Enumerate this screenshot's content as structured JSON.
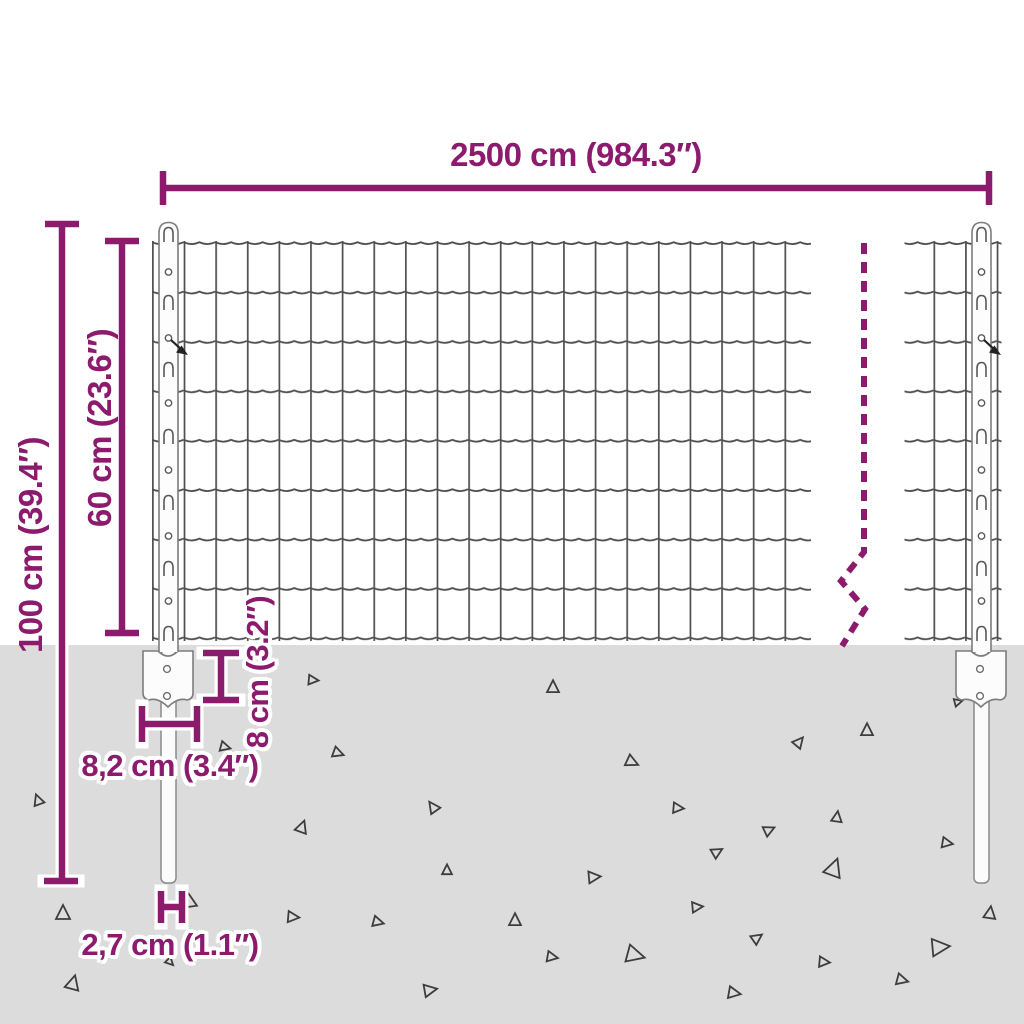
{
  "diagram": {
    "type": "product-dimension-diagram",
    "subject": "wire mesh fence panel with anchor posts",
    "dimensions": {
      "panel_width": "2500 cm (984.3″)",
      "total_post_height": "100 cm (39.4″)",
      "mesh_height": "60 cm (23.6″)",
      "anchor_plate_height": "8 cm (3.2″)",
      "anchor_plate_width": "8,2 cm (3.4″)",
      "post_width": "2,7 cm (1.1″)"
    },
    "colors": {
      "dimension_accent": "#8c1b6e",
      "ground_fill": "#dcdcdc",
      "wire_gray": "#4d4d4d",
      "post_outline": "#7d7d7d"
    }
  }
}
